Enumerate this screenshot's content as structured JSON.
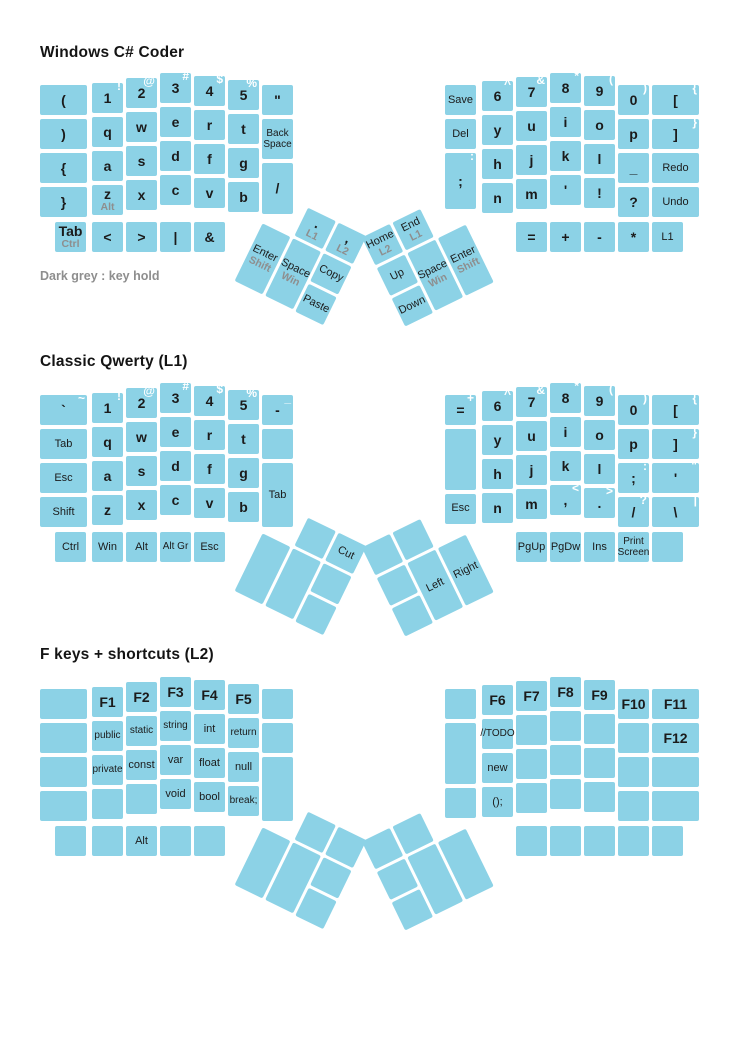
{
  "colors": {
    "key": "#8CD2E6",
    "ink": "#1b1b1b",
    "hold": "#8e8e8e",
    "shift_sup": "#ffffff",
    "background": "#ffffff"
  },
  "note": {
    "text": "Dark grey : key hold",
    "x": 40,
    "y": 269
  },
  "thumb_geometry": {
    "rotation_deg": 26,
    "center_dy": 188,
    "left_center_x": 301,
    "right_center_x": 430,
    "left_keys": [
      [
        0,
        34,
        31,
        64
      ],
      [
        34,
        0,
        31,
        31
      ],
      [
        34,
        34,
        31,
        64
      ],
      [
        68,
        0,
        31,
        31
      ],
      [
        68,
        34,
        31,
        31
      ],
      [
        68,
        68,
        31,
        31
      ]
    ],
    "right_keys": [
      [
        0,
        0,
        31,
        31
      ],
      [
        0,
        34,
        31,
        31
      ],
      [
        0,
        68,
        31,
        31
      ],
      [
        34,
        0,
        31,
        31
      ],
      [
        34,
        34,
        31,
        64
      ],
      [
        68,
        34,
        31,
        64
      ]
    ]
  },
  "keyboards": [
    {
      "title": "Windows C# Coder",
      "title_y": 44,
      "base_y": 73,
      "left": {
        "columns": [
          {
            "x": 40,
            "w": 47,
            "dy": 12,
            "keys": [
              {
                "m": "("
              },
              {
                "m": ")"
              },
              {
                "m": "{"
              },
              {
                "m": "}"
              }
            ]
          },
          {
            "x": 92,
            "dy": 10,
            "keys": [
              {
                "m": "1",
                "sup": "!"
              },
              {
                "m": "q"
              },
              {
                "m": "a"
              },
              {
                "m": "z",
                "hold": "Alt"
              }
            ]
          },
          {
            "x": 126,
            "dy": 5,
            "keys": [
              {
                "m": "2",
                "sup": "@"
              },
              {
                "m": "w"
              },
              {
                "m": "s"
              },
              {
                "m": "x"
              }
            ]
          },
          {
            "x": 160,
            "dy": 0,
            "keys": [
              {
                "m": "3",
                "sup": "#"
              },
              {
                "m": "e"
              },
              {
                "m": "d"
              },
              {
                "m": "c"
              }
            ]
          },
          {
            "x": 194,
            "dy": 3,
            "keys": [
              {
                "m": "4",
                "sup": "$"
              },
              {
                "m": "r"
              },
              {
                "m": "f"
              },
              {
                "m": "v"
              }
            ]
          },
          {
            "x": 228,
            "dy": 7,
            "keys": [
              {
                "m": "5",
                "sup": "%"
              },
              {
                "m": "t"
              },
              {
                "m": "g"
              },
              {
                "m": "b"
              }
            ]
          },
          {
            "x": 262,
            "dy": 12,
            "keys": [
              {
                "m": "\""
              },
              {
                "m": "Back\nSpace",
                "h": 1.3
              },
              {
                "m": "/",
                "h": 1.6
              }
            ]
          }
        ],
        "bottom": [
          {
            "x": 55,
            "m": "Tab",
            "hold": "Ctrl",
            "b": 1
          },
          {
            "x": 92,
            "m": "<"
          },
          {
            "x": 126,
            "m": ">"
          },
          {
            "x": 160,
            "m": "|"
          },
          {
            "x": 194,
            "m": "&"
          }
        ]
      },
      "right": {
        "columns": [
          {
            "x": 445,
            "dy": 12,
            "keys": [
              {
                "m": "Save"
              },
              {
                "m": "Del"
              },
              {
                "m": ";",
                "sup": ":",
                "h": 1.75
              }
            ]
          },
          {
            "x": 482,
            "dy": 8,
            "keys": [
              {
                "m": "6",
                "sup": "^"
              },
              {
                "m": "y"
              },
              {
                "m": "h"
              },
              {
                "m": "n"
              }
            ]
          },
          {
            "x": 516,
            "dy": 4,
            "keys": [
              {
                "m": "7",
                "sup": "&"
              },
              {
                "m": "u"
              },
              {
                "m": "j"
              },
              {
                "m": "m"
              }
            ]
          },
          {
            "x": 550,
            "dy": 0,
            "keys": [
              {
                "m": "8",
                "sup": "*"
              },
              {
                "m": "i"
              },
              {
                "m": "k"
              },
              {
                "m": "'"
              }
            ]
          },
          {
            "x": 584,
            "dy": 3,
            "keys": [
              {
                "m": "9",
                "sup": "("
              },
              {
                "m": "o"
              },
              {
                "m": "l"
              },
              {
                "m": "!"
              }
            ]
          },
          {
            "x": 618,
            "dy": 12,
            "keys": [
              {
                "m": "0",
                "sup": ")"
              },
              {
                "m": "p"
              },
              {
                "m": "_"
              },
              {
                "m": "?"
              }
            ]
          },
          {
            "x": 652,
            "w": 47,
            "dy": 12,
            "keys": [
              {
                "m": "[",
                "sup": "{"
              },
              {
                "m": "]",
                "sup": "}"
              },
              {
                "m": "Redo"
              },
              {
                "m": "Undo"
              }
            ]
          }
        ],
        "bottom": [
          {
            "x": 516,
            "m": "="
          },
          {
            "x": 550,
            "m": "+"
          },
          {
            "x": 584,
            "m": "-"
          },
          {
            "x": 618,
            "m": "*"
          },
          {
            "x": 652,
            "m": "L1"
          }
        ]
      },
      "thumb_left": [
        {
          "m": "Enter",
          "hold": "Shift"
        },
        {
          "m": ".",
          "hold": "L1"
        },
        {
          "m": "Space",
          "hold": "Win"
        },
        {
          "m": ",",
          "hold": "L2"
        },
        {
          "m": "Copy"
        },
        {
          "m": "Paste"
        }
      ],
      "thumb_right": [
        {
          "m": "Home",
          "hold": "L2"
        },
        {
          "m": "Up"
        },
        {
          "m": "Down"
        },
        {
          "m": "End",
          "hold": "L1"
        },
        {
          "m": "Space",
          "hold": "Win"
        },
        {
          "m": "Enter",
          "hold": "Shift"
        }
      ]
    },
    {
      "title": "Classic Qwerty (L1)",
      "title_y": 353,
      "base_y": 383,
      "left": {
        "columns": [
          {
            "x": 40,
            "w": 47,
            "dy": 12,
            "keys": [
              {
                "m": "`",
                "sup": "~"
              },
              {
                "m": "Tab"
              },
              {
                "m": "Esc"
              },
              {
                "m": "Shift"
              }
            ]
          },
          {
            "x": 92,
            "dy": 10,
            "keys": [
              {
                "m": "1",
                "sup": "!"
              },
              {
                "m": "q"
              },
              {
                "m": "a"
              },
              {
                "m": "z"
              }
            ]
          },
          {
            "x": 126,
            "dy": 5,
            "keys": [
              {
                "m": "2",
                "sup": "@"
              },
              {
                "m": "w"
              },
              {
                "m": "s"
              },
              {
                "m": "x"
              }
            ]
          },
          {
            "x": 160,
            "dy": 0,
            "keys": [
              {
                "m": "3",
                "sup": "#"
              },
              {
                "m": "e"
              },
              {
                "m": "d"
              },
              {
                "m": "c"
              }
            ]
          },
          {
            "x": 194,
            "dy": 3,
            "keys": [
              {
                "m": "4",
                "sup": "$"
              },
              {
                "m": "r"
              },
              {
                "m": "f"
              },
              {
                "m": "v"
              }
            ]
          },
          {
            "x": 228,
            "dy": 7,
            "keys": [
              {
                "m": "5",
                "sup": "%"
              },
              {
                "m": "t"
              },
              {
                "m": "g"
              },
              {
                "m": "b"
              }
            ]
          },
          {
            "x": 262,
            "dy": 12,
            "keys": [
              {
                "m": "-",
                "sup": "_"
              },
              {},
              {
                "m": "Tab",
                "h": 2
              }
            ]
          }
        ],
        "bottom": [
          {
            "x": 55,
            "m": "Ctrl"
          },
          {
            "x": 92,
            "m": "Win"
          },
          {
            "x": 126,
            "m": "Alt"
          },
          {
            "x": 160,
            "m": "Alt Gr"
          },
          {
            "x": 194,
            "m": "Esc"
          }
        ]
      },
      "right": {
        "columns": [
          {
            "x": 445,
            "dy": 12,
            "keys": [
              {
                "m": "=",
                "sup": "+"
              },
              {
                "h": 1.9
              },
              {
                "m": "Esc"
              }
            ]
          },
          {
            "x": 482,
            "dy": 8,
            "keys": [
              {
                "m": "6",
                "sup": "^"
              },
              {
                "m": "y"
              },
              {
                "m": "h"
              },
              {
                "m": "n"
              }
            ]
          },
          {
            "x": 516,
            "dy": 4,
            "keys": [
              {
                "m": "7",
                "sup": "&"
              },
              {
                "m": "u"
              },
              {
                "m": "j"
              },
              {
                "m": "m"
              }
            ]
          },
          {
            "x": 550,
            "dy": 0,
            "keys": [
              {
                "m": "8",
                "sup": "*"
              },
              {
                "m": "i"
              },
              {
                "m": "k"
              },
              {
                "m": ",",
                "sup": "<"
              }
            ]
          },
          {
            "x": 584,
            "dy": 3,
            "keys": [
              {
                "m": "9",
                "sup": "("
              },
              {
                "m": "o"
              },
              {
                "m": "l"
              },
              {
                "m": ".",
                "sup": ">"
              }
            ]
          },
          {
            "x": 618,
            "dy": 12,
            "keys": [
              {
                "m": "0",
                "sup": ")"
              },
              {
                "m": "p"
              },
              {
                "m": ";",
                "sup": ":"
              },
              {
                "m": "/",
                "sup": "?"
              }
            ]
          },
          {
            "x": 652,
            "w": 47,
            "dy": 12,
            "keys": [
              {
                "m": "[",
                "sup": "{"
              },
              {
                "m": "]",
                "sup": "}"
              },
              {
                "m": "'",
                "sup": "\""
              },
              {
                "m": "\\",
                "sup": "|"
              }
            ]
          }
        ],
        "bottom": [
          {
            "x": 516,
            "m": "PgUp"
          },
          {
            "x": 550,
            "m": "PgDw"
          },
          {
            "x": 584,
            "m": "Ins"
          },
          {
            "x": 618,
            "m": "Print\nScreen"
          },
          {
            "x": 652
          }
        ]
      },
      "thumb_left": [
        {},
        {},
        {},
        {
          "m": "Cut"
        },
        {},
        {}
      ],
      "thumb_right": [
        {},
        {},
        {},
        {},
        {
          "m": "Left"
        },
        {
          "m": "Right"
        }
      ]
    },
    {
      "title": "F keys + shortcuts (L2)",
      "title_y": 646,
      "base_y": 677,
      "left": {
        "columns": [
          {
            "x": 40,
            "w": 47,
            "dy": 12,
            "keys": [
              {},
              {},
              {},
              {}
            ]
          },
          {
            "x": 92,
            "dy": 10,
            "keys": [
              {
                "m": "F1",
                "b": 1
              },
              {
                "m": "public"
              },
              {
                "m": "private"
              },
              {}
            ]
          },
          {
            "x": 126,
            "dy": 5,
            "keys": [
              {
                "m": "F2",
                "b": 1
              },
              {
                "m": "static"
              },
              {
                "m": "const"
              },
              {}
            ]
          },
          {
            "x": 160,
            "dy": 0,
            "keys": [
              {
                "m": "F3",
                "b": 1
              },
              {
                "m": "string"
              },
              {
                "m": "var"
              },
              {
                "m": "void"
              }
            ]
          },
          {
            "x": 194,
            "dy": 3,
            "keys": [
              {
                "m": "F4",
                "b": 1
              },
              {
                "m": "int"
              },
              {
                "m": "float"
              },
              {
                "m": "bool"
              }
            ]
          },
          {
            "x": 228,
            "dy": 7,
            "keys": [
              {
                "m": "F5",
                "b": 1
              },
              {
                "m": "return"
              },
              {
                "m": "null"
              },
              {
                "m": "break;"
              }
            ]
          },
          {
            "x": 262,
            "dy": 12,
            "keys": [
              {},
              {},
              {
                "h": 2
              }
            ]
          }
        ],
        "bottom": [
          {
            "x": 55
          },
          {
            "x": 92
          },
          {
            "x": 126,
            "m": "Alt"
          },
          {
            "x": 160
          },
          {
            "x": 194
          }
        ]
      },
      "right": {
        "columns": [
          {
            "x": 445,
            "dy": 12,
            "keys": [
              {},
              {
                "h": 1.9
              },
              {}
            ]
          },
          {
            "x": 482,
            "dy": 8,
            "keys": [
              {
                "m": "F6",
                "b": 1
              },
              {
                "m": "//TODO"
              },
              {
                "m": "new"
              },
              {
                "m": "();"
              }
            ]
          },
          {
            "x": 516,
            "dy": 4,
            "keys": [
              {
                "m": "F7",
                "b": 1
              },
              {},
              {},
              {}
            ]
          },
          {
            "x": 550,
            "dy": 0,
            "keys": [
              {
                "m": "F8",
                "b": 1
              },
              {},
              {},
              {}
            ]
          },
          {
            "x": 584,
            "dy": 3,
            "keys": [
              {
                "m": "F9",
                "b": 1
              },
              {},
              {},
              {}
            ]
          },
          {
            "x": 618,
            "dy": 12,
            "keys": [
              {
                "m": "F10",
                "b": 1
              },
              {},
              {},
              {}
            ]
          },
          {
            "x": 652,
            "w": 47,
            "dy": 12,
            "keys": [
              {
                "m": "F11",
                "b": 1
              },
              {
                "m": "F12",
                "b": 1
              },
              {},
              {}
            ]
          }
        ],
        "bottom": [
          {
            "x": 516
          },
          {
            "x": 550
          },
          {
            "x": 584
          },
          {
            "x": 618
          },
          {
            "x": 652
          }
        ]
      },
      "thumb_left": [
        {},
        {},
        {},
        {},
        {},
        {}
      ],
      "thumb_right": [
        {},
        {},
        {},
        {},
        {},
        {}
      ]
    }
  ]
}
